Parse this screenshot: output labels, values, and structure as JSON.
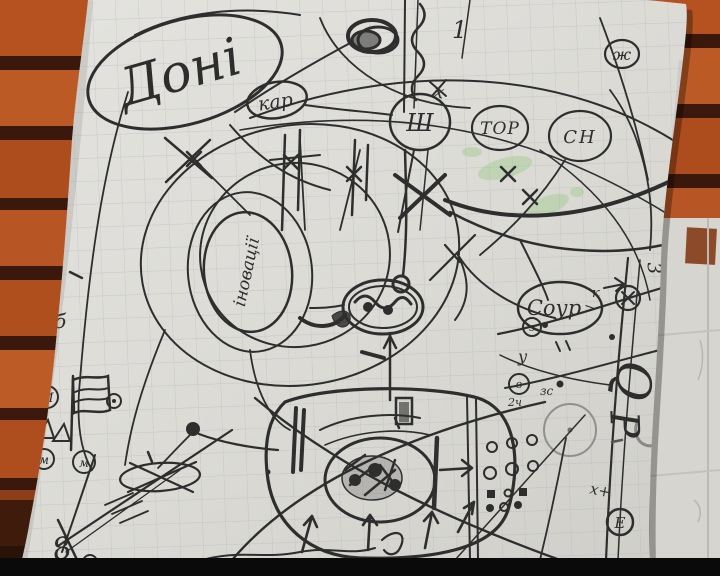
{
  "scene": {
    "type": "photo-of-hand-drawn-mindmap",
    "colors": {
      "wood_slat": "#b5521f",
      "wood_gap": "#38160a",
      "paper": "#dcdbd6",
      "grid_line": "#aab2b8",
      "ink": "#2e2e2e",
      "pencil": "#8a8a8a",
      "green_highlight": "#86c86e",
      "letterbox_bar": "#0a0a0a"
    }
  },
  "labels": {
    "title_word": "Доні",
    "kar": "кар",
    "sh": "Ш",
    "tor": "ТОР",
    "sn": "СН",
    "one": "1",
    "x_small": "х",
    "zh": "ж",
    "innovations": "іновації",
    "sour": "Соур",
    "sour_arrow": ">",
    "three_plus": "3+",
    "b_letter": "б",
    "three_rotated": "3",
    "k_letter": "к",
    "z_letter": "з",
    "u_letter": "у",
    "v_letter": "в",
    "twenty_four": "2ч",
    "zs": "зс",
    "q_letter": "Q",
    "p_letter": "Р",
    "m_big": "М",
    "m_small": "м",
    "x_plus": "х+",
    "e_letter": "Е",
    "eight": "8"
  }
}
